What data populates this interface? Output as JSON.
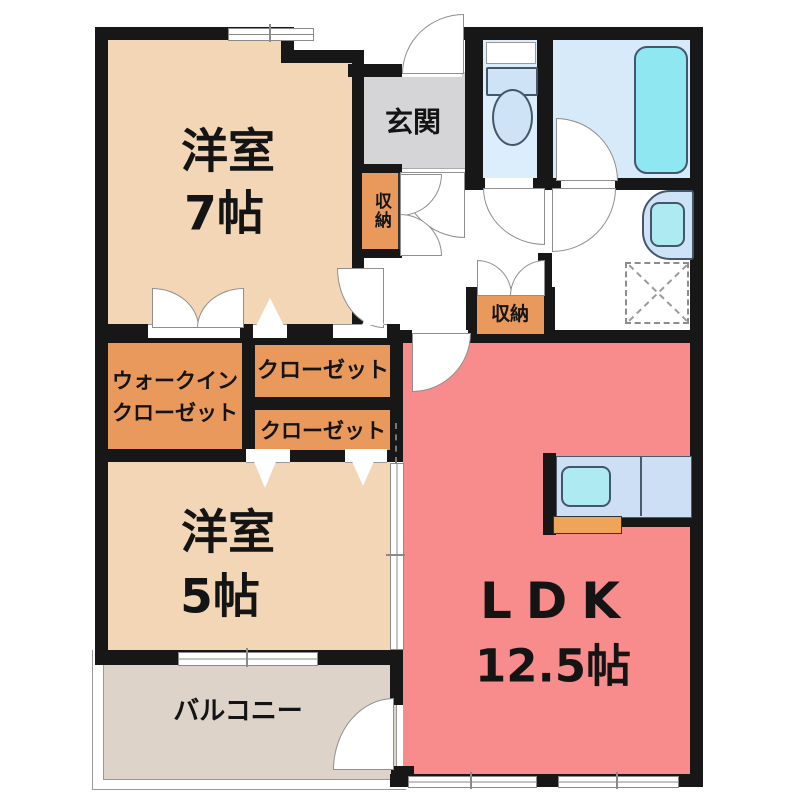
{
  "plan_title": "2LDK apartment floor plan",
  "rooms": {
    "western7": {
      "name": "洋室",
      "size": "7帖"
    },
    "western5": {
      "name": "洋室",
      "size": "5帖"
    },
    "ldk": {
      "name": "LDK",
      "size": "12.5帖"
    },
    "entrance": {
      "name": "玄関"
    },
    "balcony": {
      "name": "バルコニー"
    },
    "wic": {
      "line1": "ウォークイン",
      "line2": "クローゼット"
    },
    "closet_upper": {
      "name": "クローゼット"
    },
    "closet_lower": {
      "name": "クローゼット"
    },
    "storage_left": {
      "name": "収納"
    },
    "storage_hall": {
      "name": "収納"
    }
  },
  "fixtures": [
    "toilet",
    "bathtub",
    "wash-basin",
    "kitchen-counter",
    "kitchen-sink",
    "kitchen-stove",
    "washing-machine-pan",
    "door-swing",
    "folding-door",
    "window"
  ],
  "colors": {
    "wall": "#171717",
    "bedroom_floor": "#f3d6b6",
    "closet_orange": "#e9995c",
    "ldk_salmon": "#f88b8b",
    "entrance_gray": "#d5d5d7",
    "balcony_tan": "#ddd3c9",
    "bath_floor": "#d7eafa",
    "fixture_panel": "#cfe3f6",
    "fixture_water": "#8fe7f2",
    "kitchen_accent": "#f0a457"
  }
}
